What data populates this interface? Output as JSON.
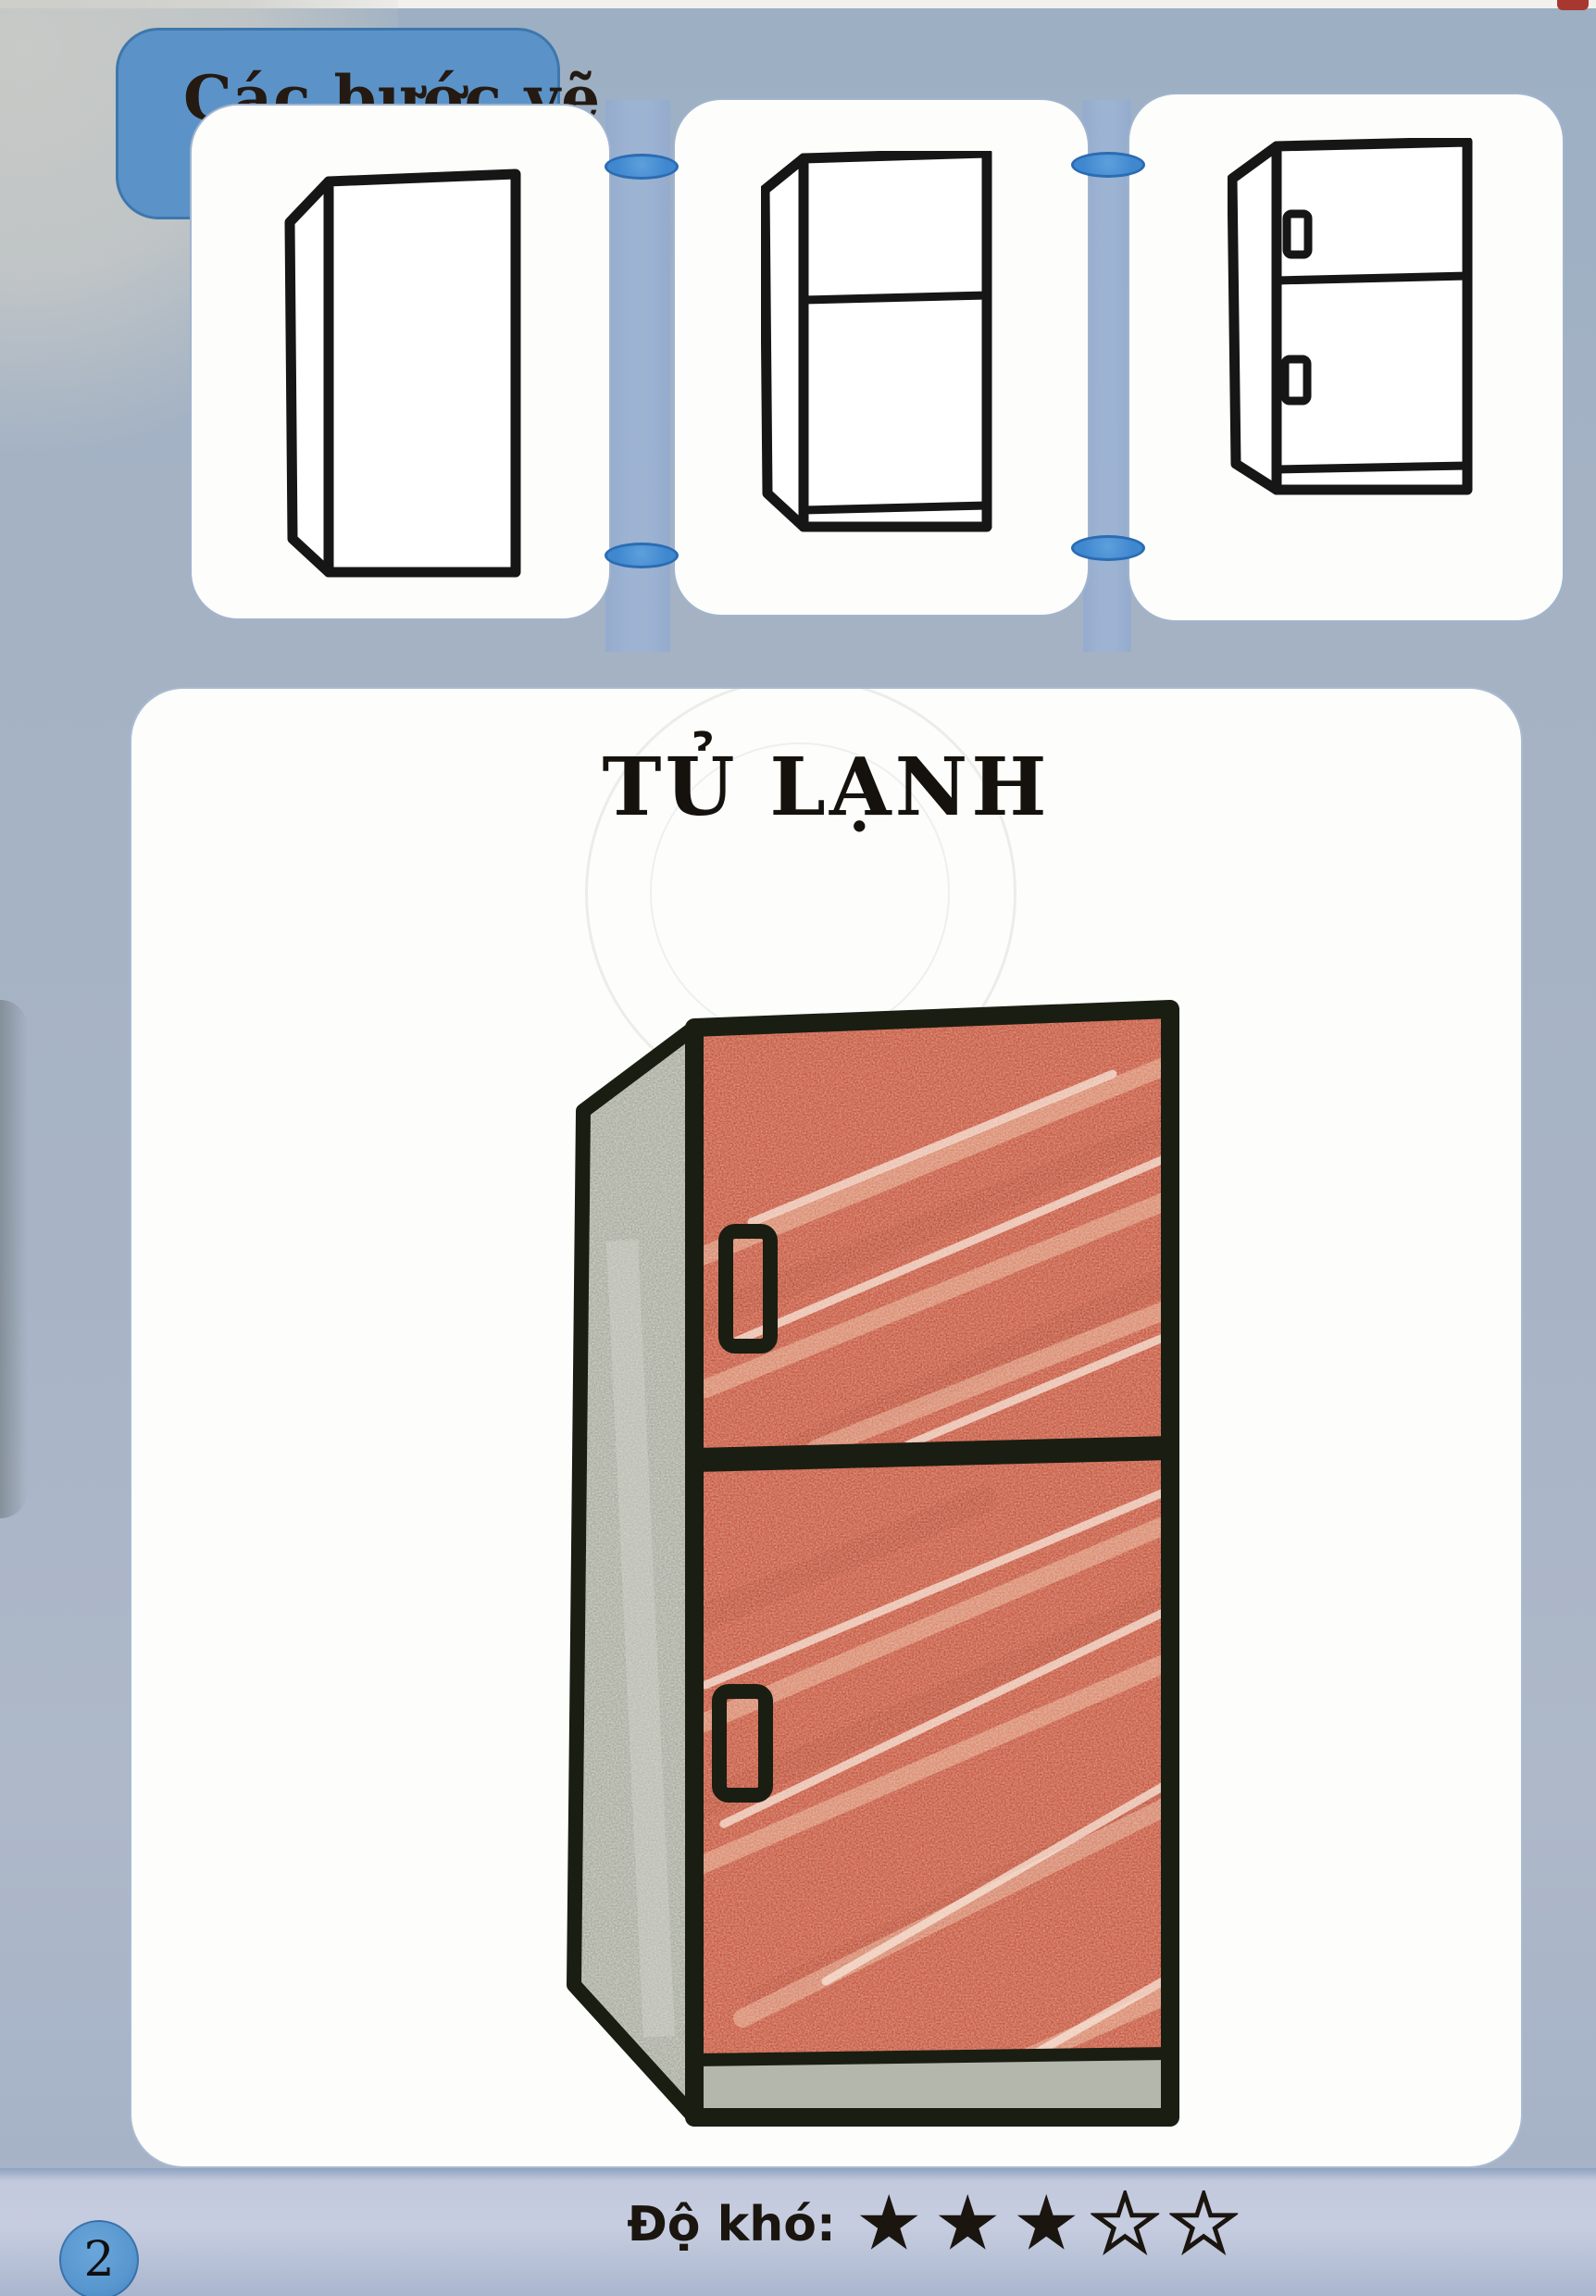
{
  "page": {
    "number": "2"
  },
  "steps_section": {
    "tab_label": "Các bước vẽ",
    "steps": [
      {
        "id": "step-1",
        "shows": "fridge-body-outline"
      },
      {
        "id": "step-2",
        "shows": "body-with-door-divider-and-base"
      },
      {
        "id": "step-3",
        "shows": "body-with-doors-handles-and-base"
      }
    ]
  },
  "main": {
    "title": "TỦ LẠNH"
  },
  "footer": {
    "difficulty_label": "Độ khó:",
    "stars_filled": 3,
    "stars_total": 5
  },
  "colors": {
    "tab_blue": "#5b93c9",
    "tab_border": "#3d77ac",
    "band_blue": "#9db3d3",
    "connector_blue": "#3f87cf",
    "connector_border": "#2b6cb2",
    "panel_white": "#fdfdfb",
    "step_outline": "#161616",
    "outline_black": "#1a1d12",
    "door_red": "#c6553d",
    "door_streak": "#e9b295",
    "door_dark_streak": "#b2452e",
    "side_gray": "#a5a99e",
    "base_gray": "#b3b7ac",
    "text_dark": "#1b150f",
    "star_color": "#1b150f",
    "footer_strip": "#c7cde0",
    "circle_blue": "#5897cf",
    "watermark_gray": "#dededb"
  }
}
